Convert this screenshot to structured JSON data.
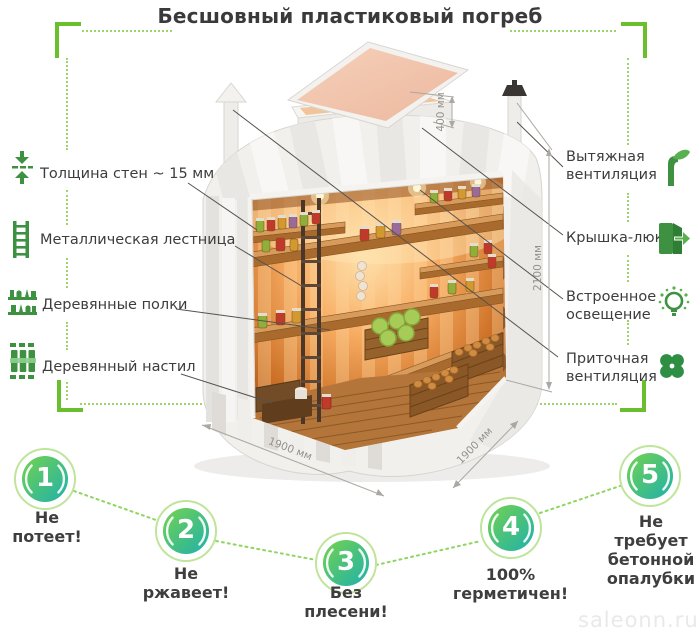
{
  "page": {
    "title": "Бесшовный пластиковый погреб",
    "watermark": "saleonn.ru"
  },
  "left_labels": [
    {
      "label": "Толщина стен ~ 15 мм",
      "icon": "wall-thickness-icon"
    },
    {
      "label": "Металлическая лестница",
      "icon": "ladder-icon"
    },
    {
      "label": "Деревянные полки",
      "icon": "shelves-icon"
    },
    {
      "label": "Деревянный настил",
      "icon": "decking-icon"
    }
  ],
  "right_labels": [
    {
      "label": "Вытяжная вентиляция",
      "icon": "exhaust-vent-icon"
    },
    {
      "label": "Крышка-люк",
      "icon": "hatch-icon"
    },
    {
      "label": "Встроенное освещение",
      "icon": "light-icon"
    },
    {
      "label": "Приточная вентиляция",
      "icon": "supply-vent-icon"
    }
  ],
  "dimensions": {
    "neck_height": "400 мм",
    "body_height": "2100 мм",
    "base_width": "1900 мм",
    "base_depth": "1900 мм"
  },
  "features": [
    {
      "number": "1",
      "label": "Не потеет!"
    },
    {
      "number": "2",
      "label": "Не ржавеет!"
    },
    {
      "number": "3",
      "label": "Без плесени!"
    },
    {
      "number": "4",
      "label": "100% герметичен!"
    },
    {
      "number": "5",
      "label": "Не требует бетонной опалубки"
    }
  ],
  "colors": {
    "accent_green": "#6abf2e",
    "dotted_green": "#9ed46a",
    "icon_green": "#3f9142",
    "badge_gradient": [
      "#74d24f",
      "#1eb1ab"
    ],
    "badge_ring": "#bfe49b",
    "label_text": "#3d3d3d",
    "dimension_text": "#94918c",
    "watermark_text": "#e9e9eb"
  }
}
